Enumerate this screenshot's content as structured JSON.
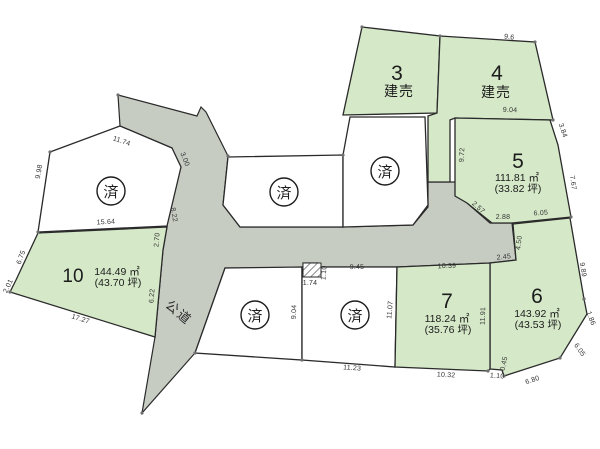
{
  "map": {
    "road_label": "公道",
    "sold_label": "済",
    "colors": {
      "available": "#d5e9c8",
      "sold": "#ffffff",
      "road": "#c7ccc3",
      "outline": "#2a2a2a"
    },
    "lots": {
      "lot3": {
        "number": "3",
        "status": "建売"
      },
      "lot4": {
        "number": "4",
        "status": "建売"
      },
      "lot5": {
        "number": "5",
        "area": "111.81 ㎡",
        "tsubo": "(33.82 坪)"
      },
      "lot6": {
        "number": "6",
        "area": "143.92 ㎡",
        "tsubo": "(43.53 坪)"
      },
      "lot7": {
        "number": "7",
        "area": "118.24 ㎡",
        "tsubo": "(35.76 坪)"
      },
      "lot10": {
        "number": "10",
        "area": "144.49 ㎡",
        "tsubo": "(43.70 坪)"
      }
    },
    "dimensions": [
      {
        "v": "11.74",
        "x": 121,
        "y": 143,
        "r": 19
      },
      {
        "v": "9.98",
        "x": 41,
        "y": 172,
        "r": -80
      },
      {
        "v": "3.00",
        "x": 183,
        "y": 160,
        "r": 68
      },
      {
        "v": "8.22",
        "x": 172,
        "y": 215,
        "r": 80
      },
      {
        "v": "15.64",
        "x": 106,
        "y": 224,
        "r": -3
      },
      {
        "v": "6.75",
        "x": 23,
        "y": 258,
        "r": -70
      },
      {
        "v": "2.01",
        "x": 10,
        "y": 287,
        "r": -65
      },
      {
        "v": "17.27",
        "x": 80,
        "y": 321,
        "r": 17
      },
      {
        "v": "2.70",
        "x": 159,
        "y": 240,
        "r": -85
      },
      {
        "v": "6.22",
        "x": 154,
        "y": 296,
        "r": -86
      },
      {
        "v": "9.6",
        "x": 509,
        "y": 39,
        "r": 7
      },
      {
        "v": "9.04",
        "x": 510,
        "y": 112,
        "r": 2
      },
      {
        "v": "9.72",
        "x": 464,
        "y": 155,
        "r": -87
      },
      {
        "v": "3.84",
        "x": 561,
        "y": 131,
        "r": 72
      },
      {
        "v": "7.67",
        "x": 571,
        "y": 183,
        "r": 82
      },
      {
        "v": "2.57",
        "x": 477,
        "y": 209,
        "r": 42
      },
      {
        "v": "2.88",
        "x": 503,
        "y": 219,
        "r": 0
      },
      {
        "v": "6.05",
        "x": 541,
        "y": 215,
        "r": -4
      },
      {
        "v": "4.50",
        "x": 521,
        "y": 243,
        "r": -83
      },
      {
        "v": "2.45",
        "x": 504,
        "y": 259,
        "r": -6
      },
      {
        "v": "9.89",
        "x": 581,
        "y": 270,
        "r": 80
      },
      {
        "v": "1.86",
        "x": 589,
        "y": 319,
        "r": 70
      },
      {
        "v": "6.05",
        "x": 578,
        "y": 351,
        "r": 55
      },
      {
        "v": "6.80",
        "x": 533,
        "y": 382,
        "r": -18
      },
      {
        "v": "0.45",
        "x": 506,
        "y": 364,
        "r": -78
      },
      {
        "v": "1.10",
        "x": 497,
        "y": 378,
        "r": 5
      },
      {
        "v": "10.32",
        "x": 446,
        "y": 377,
        "r": 3
      },
      {
        "v": "11.91",
        "x": 485,
        "y": 316,
        "r": -88
      },
      {
        "v": "11.07",
        "x": 392,
        "y": 310,
        "r": -85
      },
      {
        "v": "10.39",
        "x": 447,
        "y": 268,
        "r": -2
      },
      {
        "v": "11.23",
        "x": 352,
        "y": 370,
        "r": 4
      },
      {
        "v": "9.04",
        "x": 296,
        "y": 312,
        "r": -88
      },
      {
        "v": "9.45",
        "x": 357,
        "y": 269,
        "r": -1
      },
      {
        "v": "1.10",
        "x": 326,
        "y": 273,
        "r": -85
      },
      {
        "v": "1.74",
        "x": 310,
        "y": 285,
        "r": 0
      }
    ]
  }
}
